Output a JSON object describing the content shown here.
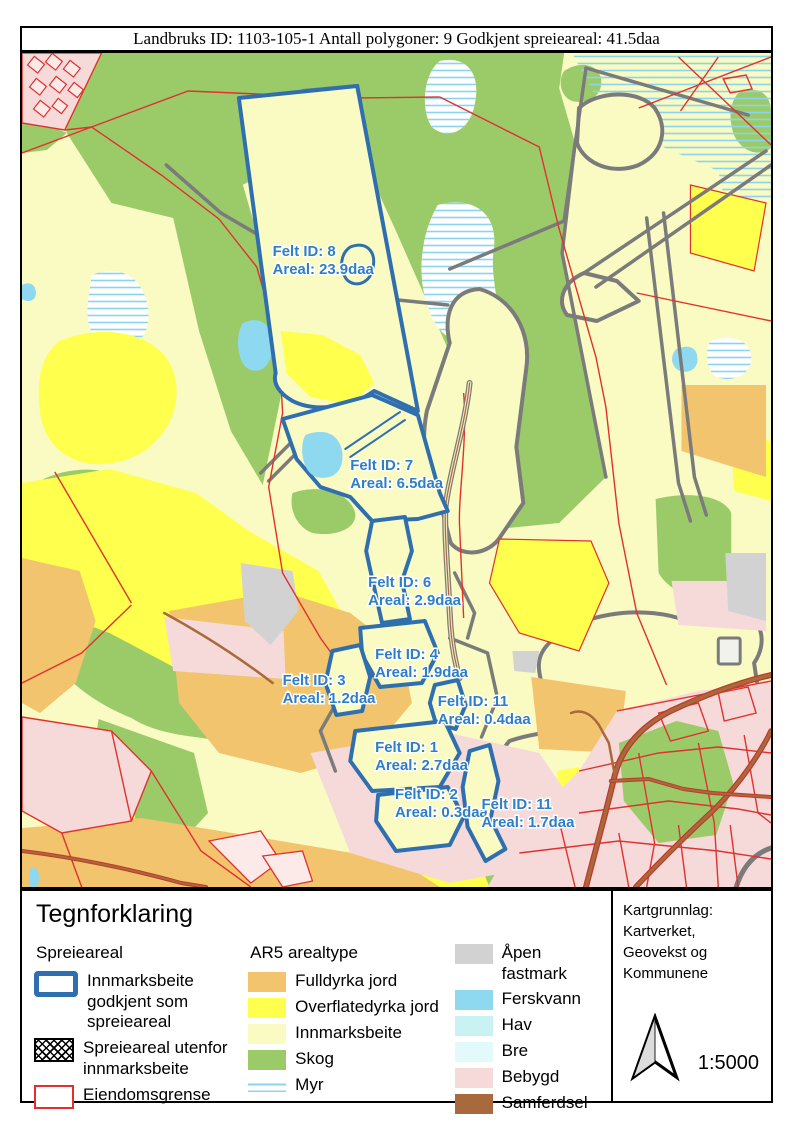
{
  "title_bar": "Landbruks ID: 1103-105-1 Antall polygoner: 9 Godkjent spreieareal: 41.5daa",
  "map": {
    "felt_labels": [
      {
        "id": "8",
        "line1": "Felt ID: 8",
        "line2": "Areal: 23.9daa"
      },
      {
        "id": "7",
        "line1": "Felt ID: 7",
        "line2": "Areal: 6.5daa"
      },
      {
        "id": "6",
        "line1": "Felt ID: 6",
        "line2": "Areal: 2.9daa"
      },
      {
        "id": "4",
        "line1": "Felt ID: 4",
        "line2": "Areal: 1.9daa"
      },
      {
        "id": "3",
        "line1": "Felt ID: 3",
        "line2": "Areal: 1.2daa"
      },
      {
        "id": "11",
        "line1": "Felt ID: 11",
        "line2": "Areal: 0.4daa"
      },
      {
        "id": "1",
        "line1": "Felt ID: 1",
        "line2": "Areal: 2.7daa"
      },
      {
        "id": "2",
        "line1": "Felt ID: 2",
        "line2": "Areal: 0.3daa"
      },
      {
        "id": "11b",
        "line1": "Felt ID: 11",
        "line2": "Areal: 1.7daa"
      }
    ],
    "colors": {
      "felt_outline": "#2F6FAF",
      "label_text": "#2F7EC8",
      "property_line": "#E0312F",
      "boundary_line": "#7B7B7B",
      "road": "#A8693C"
    }
  },
  "legend": {
    "title": "Tegnforklaring",
    "spreieareal": {
      "header": "Spreieareal",
      "items": [
        {
          "label": "Innmarksbeite godkjent som spreieareal",
          "symbol": "blue-outline",
          "color": "#2F6FAF"
        },
        {
          "label": "Spreieareal utenfor innmarksbeite",
          "symbol": "crosshatch",
          "color": "#000000"
        },
        {
          "label": "Eiendomsgrense",
          "symbol": "red-outline",
          "color": "#E0312F"
        }
      ]
    },
    "ar5": {
      "header": "AR5 arealtype",
      "items": [
        {
          "label": "Fulldyrka jord",
          "color": "#F2C46D"
        },
        {
          "label": "Overflatedyrka jord",
          "color": "#FFFF4D"
        },
        {
          "label": "Innmarksbeite",
          "color": "#FAFAC3"
        },
        {
          "label": "Skog",
          "color": "#9BCB69"
        },
        {
          "label": "Myr",
          "color": "#8AD4F0",
          "symbol": "lines"
        }
      ]
    },
    "ar5b": {
      "items": [
        {
          "label": "Åpen fastmark",
          "color": "#D2D2D2"
        },
        {
          "label": "Ferskvann",
          "color": "#8FD9F0"
        },
        {
          "label": "Hav",
          "color": "#C9F2F2"
        },
        {
          "label": "Bre",
          "color": "#E2FAFA"
        },
        {
          "label": "Bebygd",
          "color": "#F6D9D9"
        },
        {
          "label": "Samferdsel",
          "color": "#A8693C"
        }
      ]
    }
  },
  "info_box": {
    "attribution": "Kartgrunnlag: Kartverket, Geovekst og Kommunene",
    "scale": "1:5000"
  }
}
